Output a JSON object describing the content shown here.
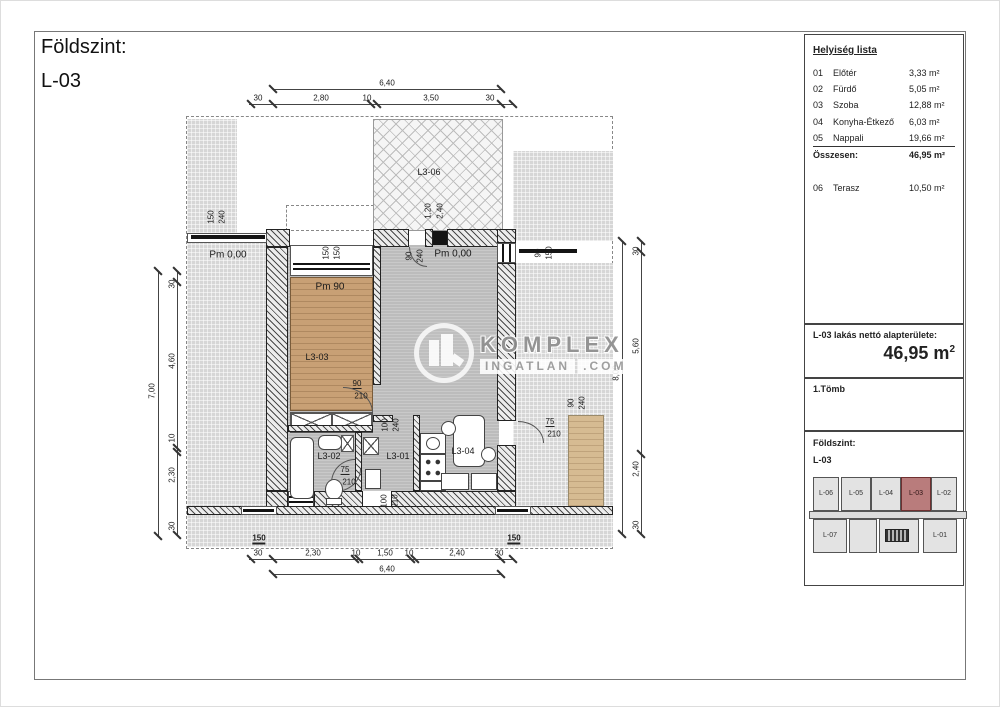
{
  "sheet_title": {
    "line1": "Földszint:",
    "line2": "L-03"
  },
  "room_list": {
    "title": "Helyiség lista",
    "rows": [
      {
        "num": "01",
        "name": "Előtér",
        "area": "3,33 m²"
      },
      {
        "num": "02",
        "name": "Fürdő",
        "area": "5,05 m²"
      },
      {
        "num": "03",
        "name": "Szoba",
        "area": "12,88 m²"
      },
      {
        "num": "04",
        "name": "Konyha-Étkező",
        "area": "6,03 m²"
      },
      {
        "num": "05",
        "name": "Nappali",
        "area": "19,66 m²",
        "u": true
      }
    ],
    "total_label": "Összesen:",
    "total_value": "46,95 m²",
    "extra": {
      "num": "06",
      "name": "Terasz",
      "area": "10,50 m²"
    }
  },
  "net_area": {
    "label": "L-03 lakás nettó alapterülete:",
    "value": "46,95 m",
    "sup": "2"
  },
  "block_label": "1.Tömb",
  "key_plan": {
    "title1": "Földszint:",
    "title2": "L-03",
    "units_top": [
      "L-06",
      "L-05",
      "L-04",
      "L-03",
      "L-02"
    ],
    "units_bottom": [
      "L-07",
      "L-01"
    ],
    "highlight": "L-03",
    "highlight_color": "#b97c7c"
  },
  "watermark": {
    "line1": "KOMPLEX",
    "line2": "INGATLAN",
    "line3": ".COM"
  },
  "plan": {
    "labels": [
      {
        "t": "6,40",
        "x": 386,
        "y": 82
      },
      {
        "t": "30",
        "x": 257,
        "y": 97
      },
      {
        "t": "2,80",
        "x": 320,
        "y": 97
      },
      {
        "t": "10",
        "x": 366,
        "y": 97
      },
      {
        "t": "3,50",
        "x": 430,
        "y": 97
      },
      {
        "t": "30",
        "x": 489,
        "y": 97
      },
      {
        "t": "30",
        "x": 257,
        "y": 552
      },
      {
        "t": "2,30",
        "x": 312,
        "y": 552
      },
      {
        "t": "10",
        "x": 355,
        "y": 552
      },
      {
        "t": "1,50",
        "x": 384,
        "y": 552
      },
      {
        "t": "10",
        "x": 408,
        "y": 552
      },
      {
        "t": "2,40",
        "x": 456,
        "y": 552
      },
      {
        "t": "30",
        "x": 498,
        "y": 552
      },
      {
        "t": "6,40",
        "x": 386,
        "y": 568
      },
      {
        "t": "7,00",
        "x": 151,
        "y": 390,
        "r": -90
      },
      {
        "t": "30",
        "x": 171,
        "y": 283,
        "r": -90
      },
      {
        "t": "4,60",
        "x": 171,
        "y": 360,
        "r": -90
      },
      {
        "t": "10",
        "x": 171,
        "y": 437,
        "r": -90
      },
      {
        "t": "2,30",
        "x": 171,
        "y": 474,
        "r": -90
      },
      {
        "t": "30",
        "x": 171,
        "y": 525,
        "r": -90
      },
      {
        "t": "8,00",
        "x": 615,
        "y": 372,
        "r": -90
      },
      {
        "t": "30",
        "x": 635,
        "y": 250,
        "r": -90
      },
      {
        "t": "5,60",
        "x": 635,
        "y": 345,
        "r": -90
      },
      {
        "t": "2,40",
        "x": 635,
        "y": 468,
        "r": -90
      },
      {
        "t": "30",
        "x": 635,
        "y": 524,
        "r": -90
      },
      {
        "t": "150",
        "x": 210,
        "y": 216,
        "r": -90
      },
      {
        "t": "240",
        "x": 221,
        "y": 216,
        "r": -90
      },
      {
        "t": "150",
        "x": 325,
        "y": 252,
        "r": -90
      },
      {
        "t": "150",
        "x": 336,
        "y": 252,
        "r": -90
      },
      {
        "t": "1,20",
        "x": 427,
        "y": 210,
        "r": -90
      },
      {
        "t": "2,40",
        "x": 439,
        "y": 210,
        "r": -90
      },
      {
        "t": "90",
        "x": 408,
        "y": 255,
        "r": -90
      },
      {
        "t": "240",
        "x": 419,
        "y": 255,
        "r": -90
      },
      {
        "t": "90",
        "x": 537,
        "y": 252,
        "r": -90
      },
      {
        "t": "150",
        "x": 548,
        "y": 252,
        "r": -90
      },
      {
        "t": "100",
        "x": 384,
        "y": 424,
        "r": -90
      },
      {
        "t": "240",
        "x": 395,
        "y": 424,
        "r": -90
      },
      {
        "t": "90",
        "x": 570,
        "y": 402,
        "r": -90
      },
      {
        "t": "240",
        "x": 581,
        "y": 402,
        "r": -90
      },
      {
        "t": "100",
        "x": 383,
        "y": 500,
        "r": -90
      },
      {
        "t": "210",
        "x": 394,
        "y": 500,
        "r": -90
      },
      {
        "t": "90",
        "x": 356,
        "y": 383,
        "cls": "u"
      },
      {
        "t": "210",
        "x": 360,
        "y": 395
      },
      {
        "t": "75",
        "x": 344,
        "y": 469,
        "cls": "u"
      },
      {
        "t": "210",
        "x": 348,
        "y": 481
      },
      {
        "t": "75",
        "x": 549,
        "y": 421,
        "cls": "u"
      },
      {
        "t": "210",
        "x": 553,
        "y": 433
      },
      {
        "t": "Pm 0,00",
        "x": 227,
        "y": 254,
        "fs": 10
      },
      {
        "t": "Pm 0,00",
        "x": 452,
        "y": 253,
        "fs": 10
      },
      {
        "t": "Pm 90",
        "x": 329,
        "y": 286,
        "fs": 10
      },
      {
        "t": "L3-06",
        "x": 428,
        "y": 171,
        "fs": 9
      },
      {
        "t": "L3-03",
        "x": 316,
        "y": 356,
        "fs": 9
      },
      {
        "t": "L3-02",
        "x": 328,
        "y": 455,
        "fs": 9
      },
      {
        "t": "L3-01",
        "x": 397,
        "y": 455,
        "fs": 9
      },
      {
        "t": "L3-04",
        "x": 462,
        "y": 450,
        "fs": 9
      },
      {
        "t": "150",
        "x": 258,
        "y": 538,
        "cls": "ub"
      },
      {
        "t": "150",
        "x": 513,
        "y": 538,
        "cls": "ub"
      }
    ]
  }
}
